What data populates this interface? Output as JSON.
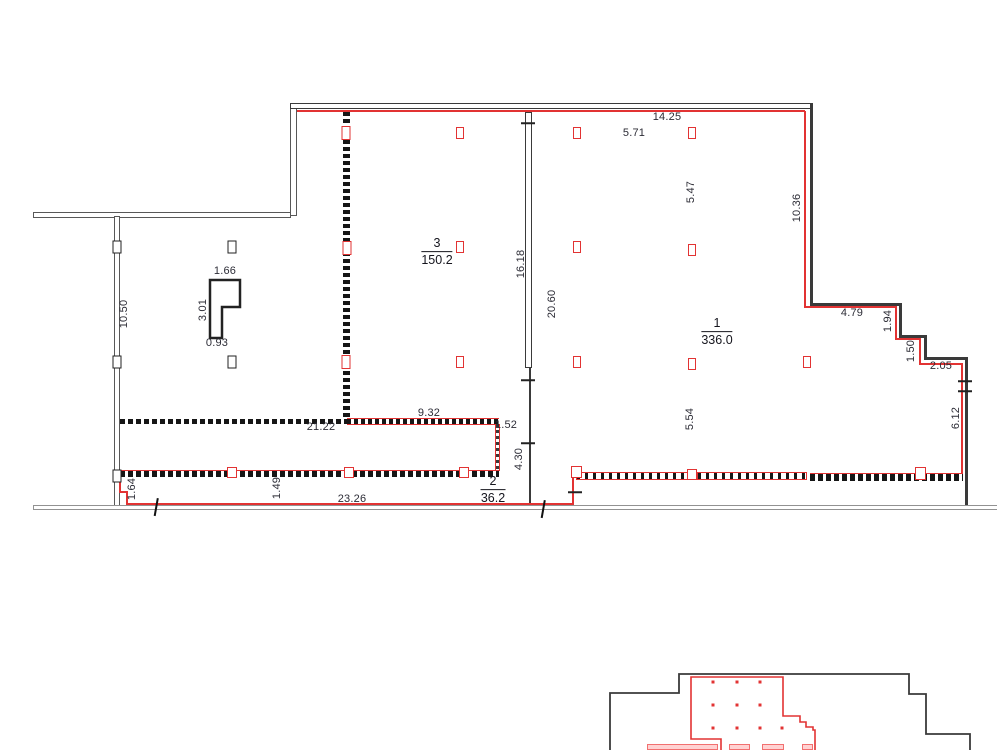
{
  "title": "floor-plan-drawing",
  "colors": {
    "red": "#e23333",
    "wall": "#3a3a3a",
    "gray": "#929292",
    "text": "#2c2c36"
  },
  "rooms": [
    {
      "number": "3",
      "area": "150.2",
      "x": 437,
      "y": 252
    },
    {
      "number": "1",
      "area": "336.0",
      "x": 717,
      "y": 332
    },
    {
      "number": "2",
      "area": "36.2",
      "x": 493,
      "y": 490
    }
  ],
  "dimension_labels": [
    {
      "t": "14.25",
      "x": 667,
      "y": 117,
      "r": 0
    },
    {
      "t": "5.71",
      "x": 634,
      "y": 133,
      "r": 0
    },
    {
      "t": "5.47",
      "x": 691,
      "y": 192,
      "r": 1
    },
    {
      "t": "10.36",
      "x": 797,
      "y": 208,
      "r": 1
    },
    {
      "t": "4.79",
      "x": 852,
      "y": 313,
      "r": 0
    },
    {
      "t": "1.94",
      "x": 888,
      "y": 321,
      "r": 1
    },
    {
      "t": "1.50",
      "x": 911,
      "y": 351,
      "r": 1
    },
    {
      "t": "2.05",
      "x": 941,
      "y": 366,
      "r": 0
    },
    {
      "t": "6.12",
      "x": 956,
      "y": 418,
      "r": 1
    },
    {
      "t": "5.54",
      "x": 690,
      "y": 419,
      "r": 1
    },
    {
      "t": "20.60",
      "x": 552,
      "y": 304,
      "r": 1
    },
    {
      "t": "16.18",
      "x": 521,
      "y": 264,
      "r": 1
    },
    {
      "t": "10.50",
      "x": 124,
      "y": 314,
      "r": 1
    },
    {
      "t": "9.32",
      "x": 429,
      "y": 413,
      "r": 0
    },
    {
      "t": "21.22",
      "x": 321,
      "y": 427,
      "r": 0
    },
    {
      "t": "1.52",
      "x": 506,
      "y": 425,
      "r": 0
    },
    {
      "t": "4.30",
      "x": 519,
      "y": 459,
      "r": 1
    },
    {
      "t": "23.26",
      "x": 352,
      "y": 499,
      "r": 0
    },
    {
      "t": "1.49",
      "x": 277,
      "y": 488,
      "r": 1
    },
    {
      "t": "1.64",
      "x": 132,
      "y": 489,
      "r": 1
    },
    {
      "t": "1.66",
      "x": 225,
      "y": 271,
      "r": 0
    },
    {
      "t": "3.01",
      "x": 203,
      "y": 310,
      "r": 1
    },
    {
      "t": "0.93",
      "x": 217,
      "y": 343,
      "r": 0
    }
  ],
  "columns": [
    {
      "x": 460,
      "y": 133,
      "v": "red"
    },
    {
      "x": 577,
      "y": 133,
      "v": "red"
    },
    {
      "x": 692,
      "y": 133,
      "v": "red"
    },
    {
      "x": 460,
      "y": 247,
      "v": "red"
    },
    {
      "x": 577,
      "y": 247,
      "v": "red"
    },
    {
      "x": 692,
      "y": 250,
      "v": "red"
    },
    {
      "x": 460,
      "y": 362,
      "v": "red"
    },
    {
      "x": 577,
      "y": 362,
      "v": "red"
    },
    {
      "x": 692,
      "y": 364,
      "v": "red"
    },
    {
      "x": 807,
      "y": 362,
      "v": "red"
    },
    {
      "x": 346,
      "y": 133,
      "v": "redwall"
    },
    {
      "x": 347,
      "y": 248,
      "v": "redwall"
    },
    {
      "x": 346,
      "y": 362,
      "v": "redwall"
    },
    {
      "x": 117,
      "y": 247,
      "v": "black"
    },
    {
      "x": 117,
      "y": 362,
      "v": "black"
    },
    {
      "x": 117,
      "y": 476,
      "v": "black"
    },
    {
      "x": 232,
      "y": 247,
      "v": "black"
    },
    {
      "x": 232,
      "y": 362,
      "v": "black"
    }
  ],
  "ticks": [
    {
      "x": 528,
      "y": 123,
      "o": "h"
    },
    {
      "x": 528,
      "y": 380,
      "o": "h"
    },
    {
      "x": 528,
      "y": 443,
      "o": "h"
    },
    {
      "x": 965,
      "y": 381,
      "o": "h"
    },
    {
      "x": 965,
      "y": 391,
      "o": "h"
    },
    {
      "x": 575,
      "y": 492,
      "o": "h"
    },
    {
      "x": 156,
      "y": 507,
      "o": "v"
    },
    {
      "x": 543,
      "y": 509,
      "o": "v"
    }
  ],
  "key_plan": {
    "dots": [
      [
        713,
        682
      ],
      [
        737,
        682
      ],
      [
        760,
        682
      ],
      [
        713,
        705
      ],
      [
        737,
        705
      ],
      [
        760,
        705
      ],
      [
        713,
        728
      ],
      [
        737,
        728
      ],
      [
        760,
        728
      ],
      [
        782,
        728
      ]
    ],
    "pink_bars": [
      [
        647,
        744,
        71,
        6
      ],
      [
        729,
        744,
        21,
        6
      ],
      [
        762,
        744,
        22,
        6
      ],
      [
        802,
        744,
        11,
        6
      ]
    ]
  }
}
